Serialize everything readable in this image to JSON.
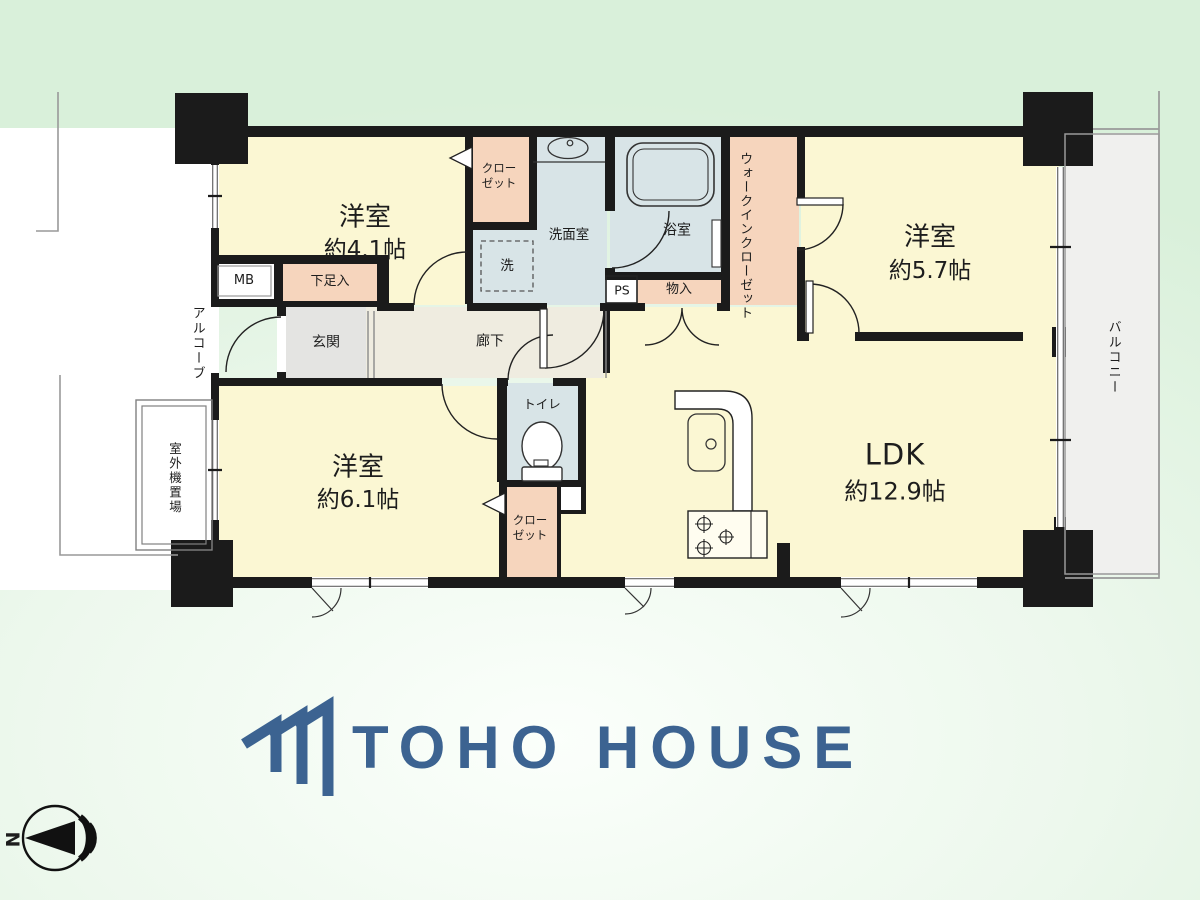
{
  "floorplan": {
    "rooms": {
      "bedroom_41": {
        "name": "洋室",
        "size": "約4.1帖"
      },
      "bedroom_57": {
        "name": "洋室",
        "size": "約5.7帖"
      },
      "bedroom_61": {
        "name": "洋室",
        "size": "約6.1帖"
      },
      "ldk": {
        "name": "LDK",
        "size": "約12.9帖"
      },
      "washroom": {
        "name": "洗面室"
      },
      "washer": {
        "name": "洗"
      },
      "bathroom": {
        "name": "浴室"
      },
      "toilet": {
        "name": "トイレ"
      },
      "hallway": {
        "name": "廊下"
      },
      "entrance": {
        "name": "玄関"
      }
    },
    "storage": {
      "closet_upper": {
        "line1": "クロー",
        "line2": "ゼット"
      },
      "closet_lower": {
        "line1": "クロー",
        "line2": "ゼット"
      },
      "walk_in_closet": {
        "name": "ウォークインクローゼット"
      },
      "shoe_box": {
        "name": "下足入"
      },
      "storage_small": {
        "name": "物入"
      }
    },
    "exterior": {
      "balcony": "バルコニー",
      "alcove": "アルコーブ",
      "outdoor_unit": "室外機置場"
    },
    "utility": {
      "meter_box": "MB",
      "pipe_space": "PS"
    },
    "compass": {
      "north_label": "N"
    }
  },
  "branding": {
    "company": "TOHO HOUSE"
  },
  "colors": {
    "background_green": "#d9f0da",
    "wall_black": "#1b1b1b",
    "room_yellow": "#fbf7d3",
    "wet_blue": "#d8e4e7",
    "storage_pink": "#f6d5bd",
    "hall_beige": "#efece0",
    "genkan_gray": "#e4e4e2",
    "balcony_gray": "#f0f0ee",
    "logo_blue": "#3c6391"
  }
}
